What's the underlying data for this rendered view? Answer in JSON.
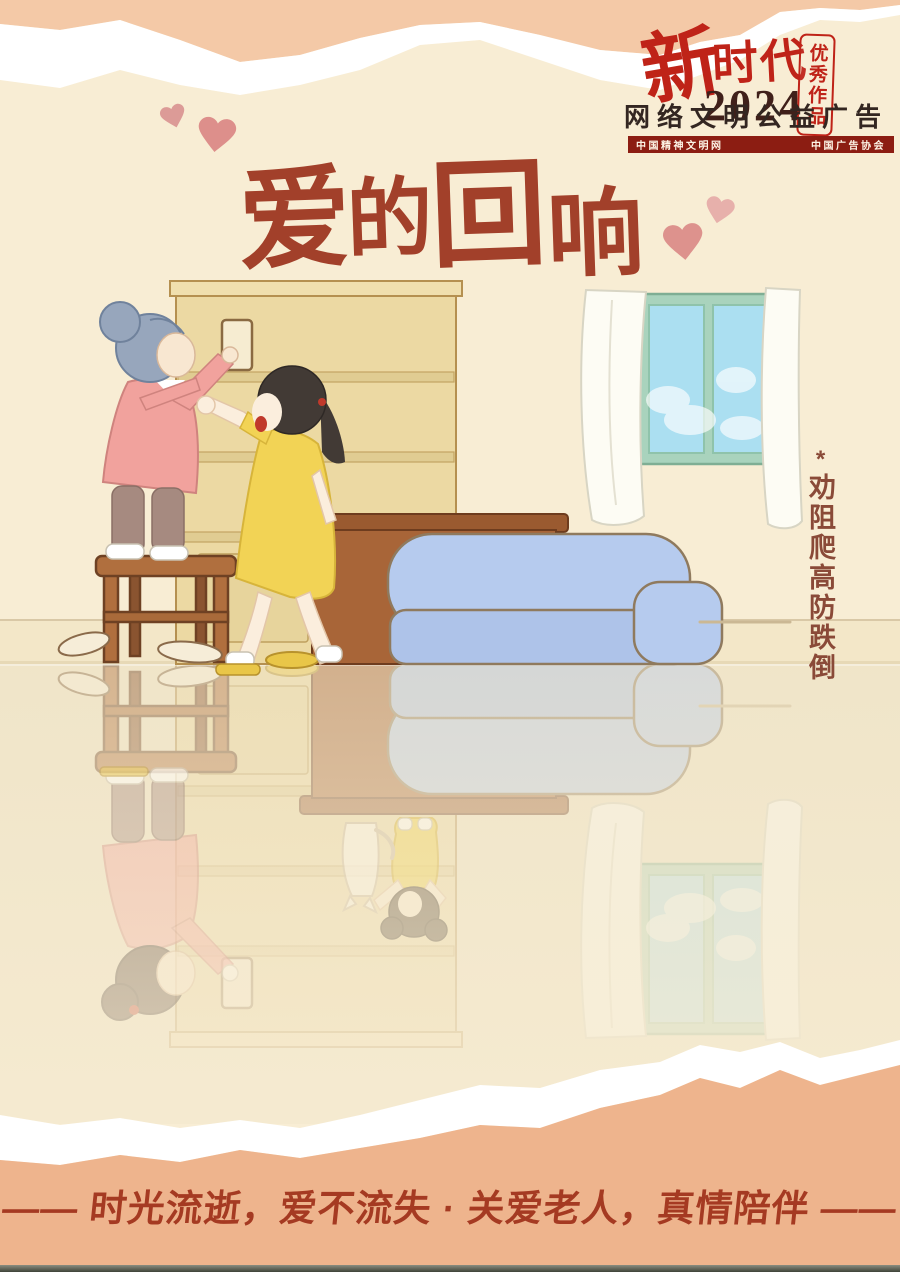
{
  "logo": {
    "brand_char": "新",
    "brand_rest": "时代",
    "year": "2024",
    "seal_text": "优秀作品",
    "subtitle": "网络文明公益广告",
    "org_left": "中国精神文明网",
    "org_right": "中国广告协会"
  },
  "title": {
    "text": "爱的回响",
    "chars": [
      "爱",
      "的",
      "回",
      "响"
    ]
  },
  "annotation": {
    "marker": "*",
    "text": "劝阻爬高防跌倒"
  },
  "slogan": {
    "text": "—— 时光流逝，爱不流失 · 关爱老人，真情陪伴 ——"
  },
  "colors": {
    "background_cream": "#f8edd4",
    "band_salmon_top": "#f4c9a7",
    "band_salmon_bottom": "#eeb48d",
    "torn_edge_white": "#ffffff",
    "logo_red": "#bf2318",
    "year_dark_maroon": "#40201a",
    "banner_dark_red": "#8c1d12",
    "title_brown_red": "#a2402a",
    "annotation_brown": "#8a4a38",
    "slogan_red": "#a53a22",
    "heart_pink": "#dd928d",
    "sofa_blue": "#b6cbee",
    "window_frame_teal": "#a9d3bd",
    "sky_blue": "#abdff1",
    "wood_brown": "#a86538",
    "bookshelf_tan": "#ecd9a3"
  },
  "illustration": {
    "description": "An elderly mother with gray hair climbs a wooden stool to reach a glass on a tall shelf while her adult daughter in a yellow dress rushes over, calling out to stop her. A blue sofa, side table, and a window with white curtains sit in the room. The glossy floor reflects an inverted scene from the past: the mother, young with dark hair, stands on the stool while her little daughter and a white cat reach up from below.",
    "elements": [
      "bookshelf",
      "glass-cup",
      "elderly-woman-on-stool",
      "wooden-stool",
      "daughter-reaching",
      "sofa",
      "side-table",
      "window",
      "curtains",
      "slippers",
      "floor-reflection",
      "young-mother-reflection",
      "little-girl-reflection",
      "white-cat-reflection"
    ]
  }
}
